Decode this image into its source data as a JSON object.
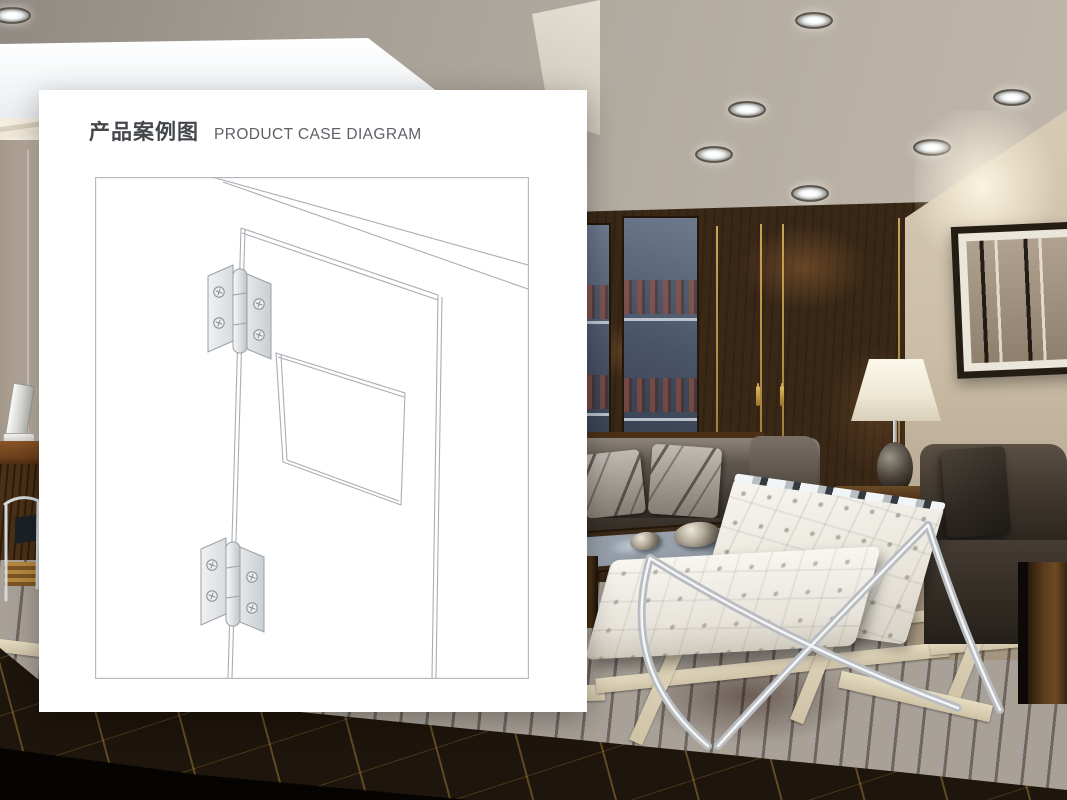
{
  "card": {
    "title_zh": "产品案例图",
    "title_en": "PRODUCT CASE DIAGRAM"
  },
  "diagram": {
    "subject": "door-leaf-with-two-butt-hinges",
    "hinge_count": 2,
    "line_color": "#a9aeb3",
    "hinge_fill": "#e9ebed"
  },
  "scene": {
    "description_colors": {
      "ceiling": "#b2aba0",
      "wood_wall": "#3a2817",
      "right_wall": "#cbbda6",
      "floor_wood": "#7a4520",
      "floor_marble": "#1e150c",
      "sofa_leather": "#453c32",
      "chair_leather_white": "#efece5"
    },
    "ceiling_spotlight_count": 7
  }
}
